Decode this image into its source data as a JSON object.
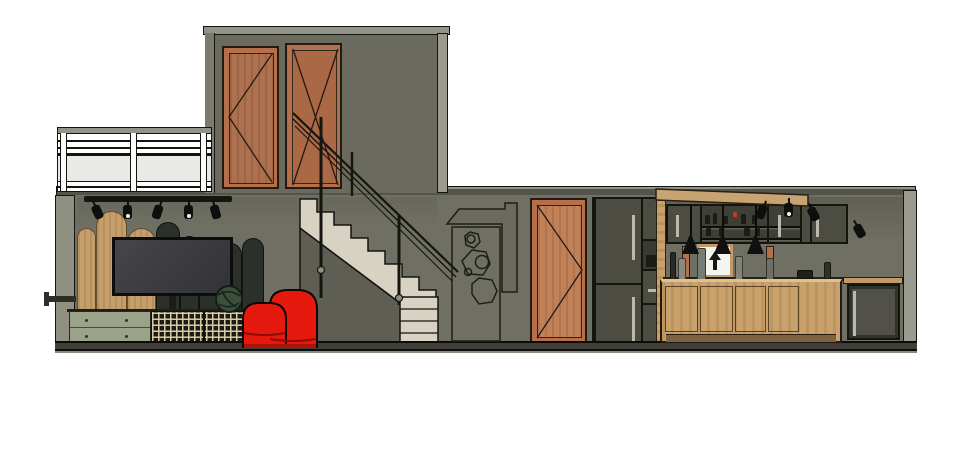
{
  "meta": {
    "description": "Architectural cross-section elevation render of a two-level loft apartment on white background",
    "visible_text": []
  },
  "palette": {
    "wall": "#6f6f63",
    "wall-upper": "#6a6a5e",
    "slab": "#55544c",
    "slab-light": "#93938a",
    "col": "#8f8f82",
    "col-light": "#9a9a90",
    "outline": "#15150f",
    "copper": "#b56f4a",
    "wood-door": "#ad7150",
    "wood-door2": "#c08058",
    "oak": "#c9a16c",
    "oak-dark": "#8a6f45",
    "cab-dark": "#4c4c42",
    "cab-darker": "#3a3a32",
    "sage": "#9aa28a",
    "cream": "#d8d2c2",
    "beige": "#d6cdb4",
    "red": "#e6190e",
    "glass": "#e9e9e7",
    "rattan-bg": "#1b1b15",
    "rattan-line": "#d9cba6",
    "green": "#3c4f3c"
  },
  "scene": {
    "rooms": [
      "upper-bedroom",
      "balcony",
      "living-room",
      "staircase",
      "hallway",
      "kitchen"
    ],
    "objects": [
      "balcony-glass-railing",
      "wood-panel-door-upper",
      "glass-door-upper",
      "stair-railing",
      "track-lighting",
      "arched-wood-slat-wall",
      "wall-mounted-tv",
      "knot-plant",
      "sideboard",
      "rattan-cabinet",
      "vintage-radio",
      "red-armchair",
      "staircase",
      "geometric-wall-art",
      "wood-panel-door-hall",
      "fridge-tall-cabinet",
      "kitchen-upper-cabinets",
      "glass-shelf-cabinet",
      "arrow-poster",
      "pendant-lights",
      "kitchen-island",
      "dishwasher",
      "wood-canopy"
    ]
  },
  "living_room": {
    "slats": [
      {
        "x": 77,
        "w": 19,
        "top": 228,
        "tone": "light"
      },
      {
        "x": 96,
        "w": 31,
        "top": 211,
        "tone": "light"
      },
      {
        "x": 127,
        "w": 29,
        "top": 228,
        "tone": "light"
      },
      {
        "x": 156,
        "w": 24,
        "top": 222,
        "tone": "dark"
      },
      {
        "x": 180,
        "w": 19,
        "top": 236,
        "tone": "dark"
      },
      {
        "x": 199,
        "w": 20,
        "top": 240,
        "tone": "dark"
      },
      {
        "x": 219,
        "w": 23,
        "top": 243,
        "tone": "dark"
      },
      {
        "x": 242,
        "w": 22,
        "top": 238,
        "tone": "dark"
      }
    ],
    "slat_bottom": 311,
    "track_spots": [
      {
        "x": 93,
        "rot": -25,
        "lens": false
      },
      {
        "x": 123,
        "rot": 0,
        "lens": true
      },
      {
        "x": 153,
        "rot": 18,
        "lens": false
      },
      {
        "x": 184,
        "rot": 0,
        "lens": true
      },
      {
        "x": 211,
        "rot": -15,
        "lens": false
      }
    ],
    "drawer_knobs": [
      {
        "x": 85,
        "y": 319
      },
      {
        "x": 125,
        "y": 319
      },
      {
        "x": 85,
        "y": 335
      },
      {
        "x": 125,
        "y": 335
      }
    ]
  },
  "kitchen": {
    "pendants": [
      {
        "x": 690
      },
      {
        "x": 722
      },
      {
        "x": 755
      }
    ],
    "spots": [
      {
        "x": 757,
        "y": 205,
        "rot": 20,
        "lens": false
      },
      {
        "x": 784,
        "y": 203,
        "rot": 0,
        "lens": true
      },
      {
        "x": 809,
        "y": 207,
        "rot": -28,
        "lens": false
      },
      {
        "x": 855,
        "y": 224,
        "rot": -30,
        "lens": false
      }
    ],
    "counter_items": [
      {
        "x": 670,
        "y": 252,
        "w": 6,
        "h": 28,
        "c": "#2a2a24"
      },
      {
        "x": 678,
        "y": 258,
        "w": 8,
        "h": 22,
        "c": "#8a8a80"
      },
      {
        "x": 697,
        "y": 248,
        "w": 9,
        "h": 32,
        "c": "#777d74"
      },
      {
        "x": 735,
        "y": 256,
        "w": 8,
        "h": 24,
        "c": "#83837b"
      },
      {
        "x": 766,
        "y": 258,
        "w": 8,
        "h": 22,
        "c": "#6f6f66"
      },
      {
        "x": 797,
        "y": 270,
        "w": 16,
        "h": 9,
        "c": "#20201a"
      },
      {
        "x": 824,
        "y": 262,
        "w": 7,
        "h": 17,
        "c": "#30302a"
      }
    ],
    "shelf_items": [
      {
        "x": 705,
        "y": 215,
        "w": 5,
        "h": 9,
        "c": "#1c1c16"
      },
      {
        "x": 713,
        "y": 213,
        "w": 4,
        "h": 11,
        "c": "#1c1c16"
      },
      {
        "x": 722,
        "y": 216,
        "w": 6,
        "h": 8,
        "c": "#1c1c16"
      },
      {
        "x": 733,
        "y": 212,
        "w": 4,
        "h": 5,
        "c": "#c0392b"
      },
      {
        "x": 741,
        "y": 214,
        "w": 5,
        "h": 10,
        "c": "#1c1c16"
      },
      {
        "x": 752,
        "y": 215,
        "w": 5,
        "h": 9,
        "c": "#1c1c16"
      },
      {
        "x": 706,
        "y": 228,
        "w": 5,
        "h": 8,
        "c": "#1c1c16"
      },
      {
        "x": 719,
        "y": 227,
        "w": 4,
        "h": 9,
        "c": "#1c1c16"
      },
      {
        "x": 744,
        "y": 228,
        "w": 6,
        "h": 8,
        "c": "#1c1c16"
      },
      {
        "x": 756,
        "y": 227,
        "w": 4,
        "h": 9,
        "c": "#1c1c16"
      }
    ],
    "island_panels": [
      {
        "x": 665,
        "w": 33
      },
      {
        "x": 700,
        "w": 33
      },
      {
        "x": 735,
        "w": 31
      },
      {
        "x": 768,
        "w": 31
      }
    ]
  }
}
